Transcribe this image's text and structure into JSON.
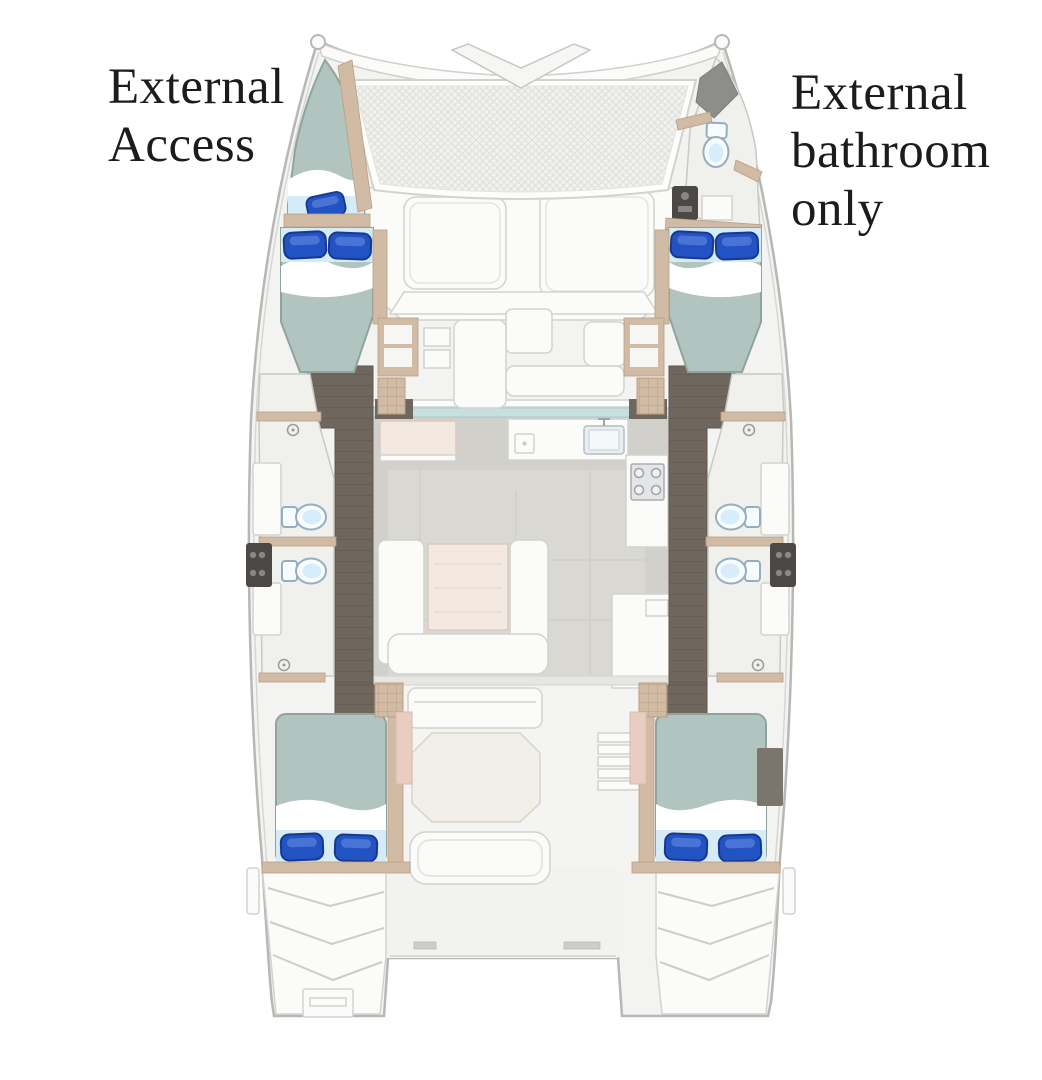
{
  "figure": {
    "type": "yacht-deck-plan",
    "vessel": "catamaran",
    "annotations": {
      "port_bow": {
        "lines": [
          "External",
          "Access"
        ]
      },
      "starboard_bow": {
        "lines": [
          "External",
          "bathroom",
          "only"
        ]
      }
    },
    "features": {
      "port_forepeak": "single berth with external access",
      "starboard_forepeak": "external-access bathroom with toilet",
      "port_forward_cabin": "double berth",
      "starboard_forward_cabin": "double berth",
      "port_midship": "two bathrooms with toilets and vanities",
      "starboard_midship": "two bathrooms with toilets and vanities",
      "port_aft_cabin": "double berth",
      "starboard_aft_cabin": "double berth",
      "saloon": "galley with sink and stove, dining settee with table",
      "foredeck": "trampoline, sun pads and forward seating",
      "cockpit": "cockpit table, bench and steps",
      "stern": "twin transom steps with boarding ladder"
    },
    "counts": {
      "cabins": 4,
      "berths": 5,
      "toilets": 5,
      "pillows": 9
    }
  },
  "colors": {
    "background": "#ffffff",
    "text": "#1c1c1c",
    "hull_fill": "#f3f3f1",
    "hull_stroke": "#b7b7b4",
    "deck_white": "#fbfbfa",
    "panel_stroke": "#d2d2cf",
    "room_white": "#f0f0ed",
    "walkway_brown": "#6f665d",
    "walkway_seam": "#5f574f",
    "wood_trim": "#d2bba4",
    "wood_dark": "#b89e85",
    "wood_pink": "#e8cdc0",
    "bed_sage": "#b2c4bf",
    "bed_stroke": "#8fa49f",
    "bed_lightblue": "#d6ebf8",
    "pillow_blue": "#2353c2",
    "pillow_light": "#5e86e0",
    "pillow_dark": "#16388f",
    "toilet_stroke": "#94aec1",
    "toilet_inner": "#d8edfb",
    "saloon_floor": "#d2d0ca",
    "saloon_floor_light": "#dcdad4",
    "table_cream": "#f3e9e1",
    "window_teal": "#c6e0e0",
    "fixture_dark": "#4c4845",
    "locker_gray": "#8d8d8b",
    "cockpit_table": "#f1efe8",
    "mesh_bg": "#f1f1ef",
    "mesh_line": "#dededb"
  }
}
